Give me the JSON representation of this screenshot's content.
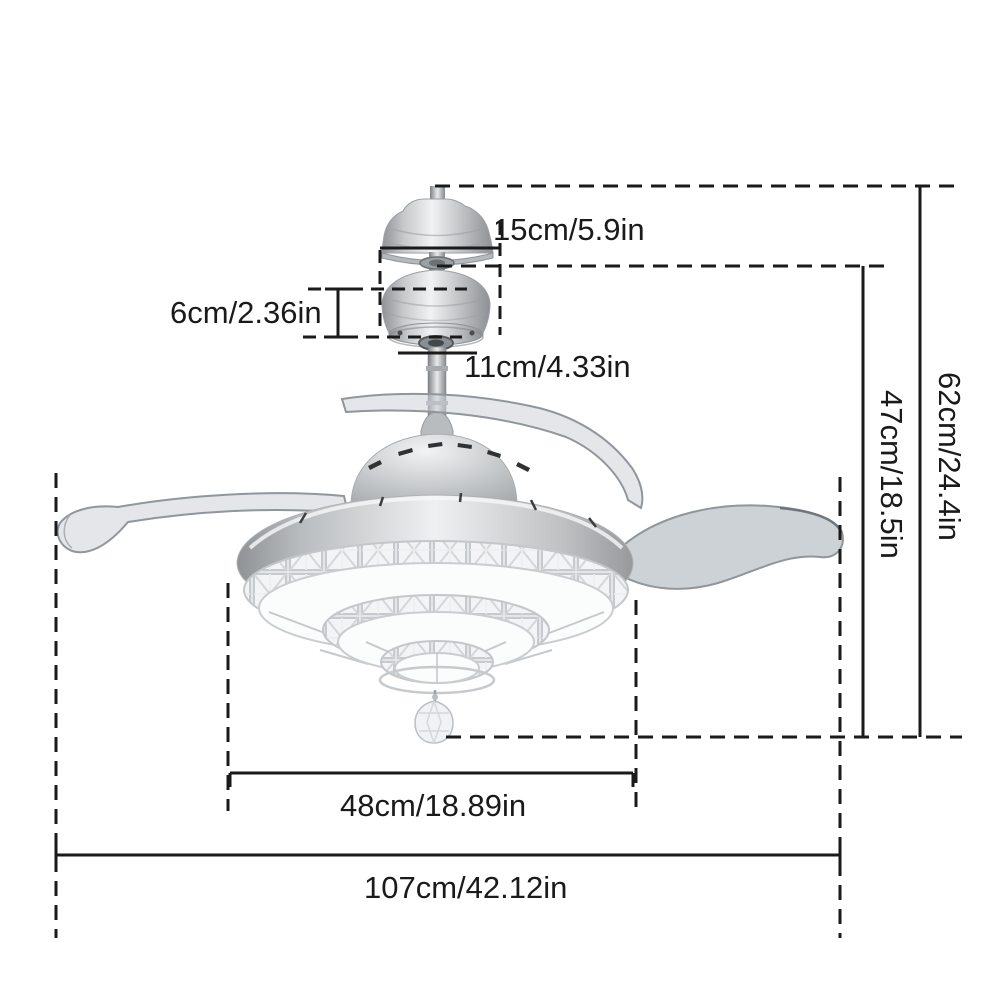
{
  "colors": {
    "line": "#1a1a1a",
    "background": "#ffffff",
    "metal-light": "#f1f2f3",
    "metal-dark": "#8f9296",
    "blade": "#cdd2d6",
    "shade-white": "#fbfcfc"
  },
  "diagram": {
    "dimensions": {
      "canopy_width": "15cm/5.9in",
      "mount_height": "6cm/2.36in",
      "mount_width": "11cm/4.33in",
      "overall_height": "62cm/24.4in",
      "fan_body_height": "47cm/18.5in",
      "body_diameter": "48cm/18.89in",
      "blade_span": "107cm/42.12in"
    }
  }
}
